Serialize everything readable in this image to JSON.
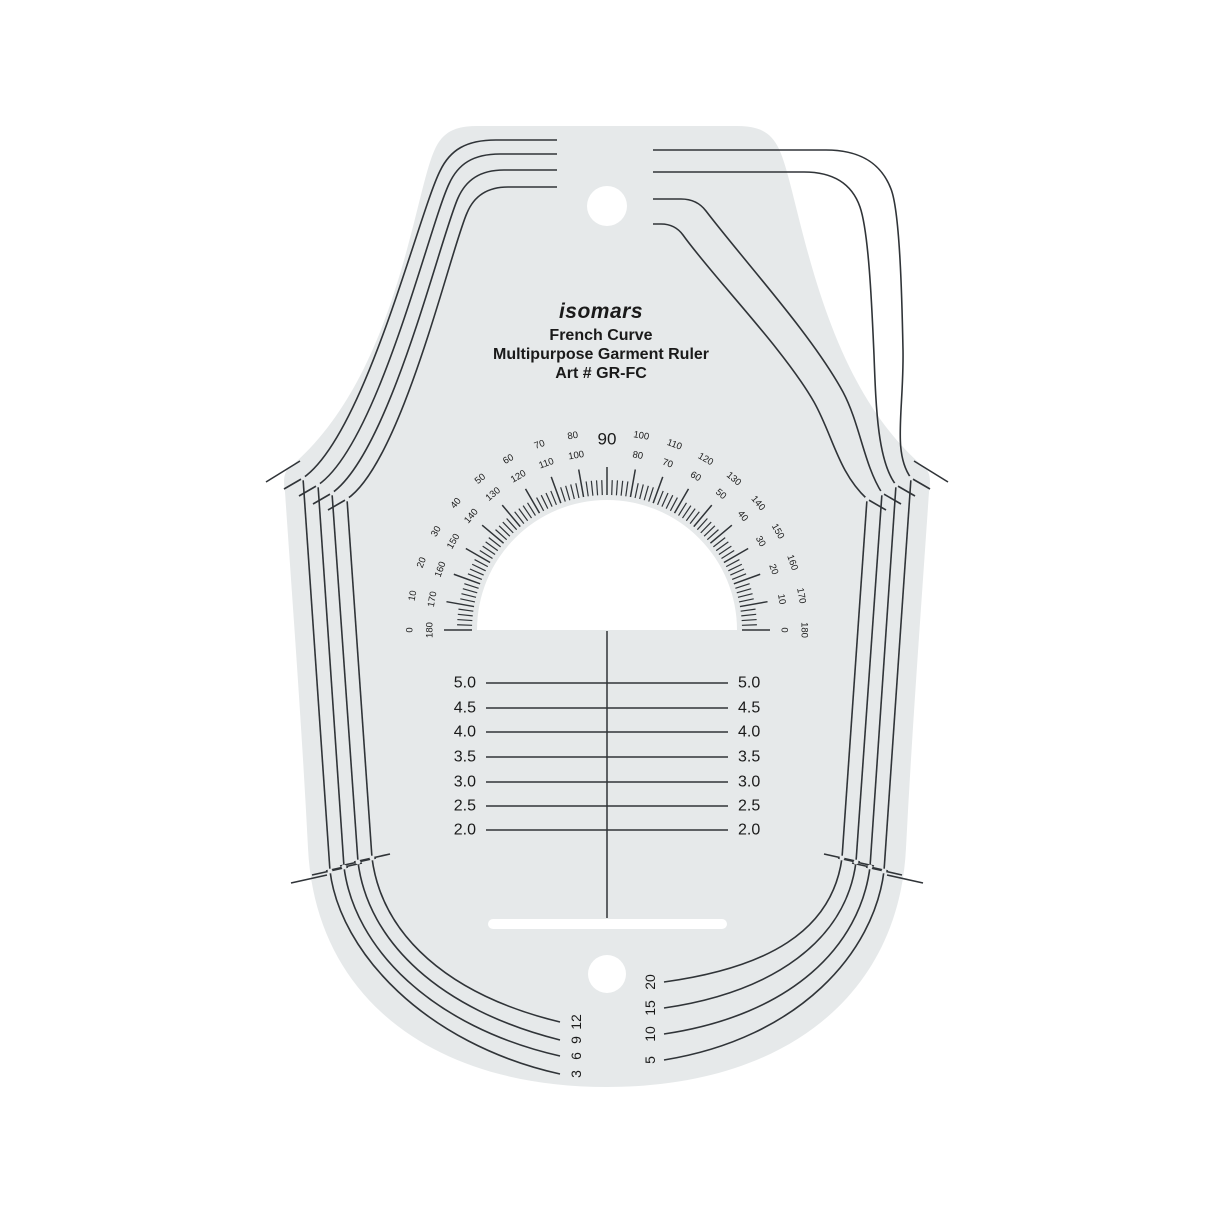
{
  "title_block": {
    "brand": "isomars",
    "product": "French Curve",
    "description": "Multipurpose Garment Ruler",
    "art_code": "Art # GR-FC"
  },
  "protractor": {
    "apex_label": "90",
    "degree_pairs": [
      {
        "angle": 0,
        "outer": "0",
        "inner": "180"
      },
      {
        "angle": 10,
        "outer": "10",
        "inner": "170"
      },
      {
        "angle": 20,
        "outer": "20",
        "inner": "160"
      },
      {
        "angle": 30,
        "outer": "30",
        "inner": "150"
      },
      {
        "angle": 40,
        "outer": "40",
        "inner": "140"
      },
      {
        "angle": 50,
        "outer": "50",
        "inner": "130"
      },
      {
        "angle": 60,
        "outer": "60",
        "inner": "120"
      },
      {
        "angle": 70,
        "outer": "70",
        "inner": "110"
      },
      {
        "angle": 80,
        "outer": "80",
        "inner": "100"
      },
      {
        "angle": 100,
        "outer": "100",
        "inner": "80"
      },
      {
        "angle": 110,
        "outer": "110",
        "inner": "70"
      },
      {
        "angle": 120,
        "outer": "120",
        "inner": "60"
      },
      {
        "angle": 130,
        "outer": "130",
        "inner": "50"
      },
      {
        "angle": 140,
        "outer": "140",
        "inner": "40"
      },
      {
        "angle": 150,
        "outer": "150",
        "inner": "30"
      },
      {
        "angle": 160,
        "outer": "160",
        "inner": "20"
      },
      {
        "angle": 170,
        "outer": "170",
        "inner": "10"
      },
      {
        "angle": 180,
        "outer": "180",
        "inner": "0"
      }
    ]
  },
  "vertical_scale": {
    "values": [
      "5.0",
      "4.5",
      "4.0",
      "3.5",
      "3.0",
      "2.5",
      "2.0"
    ]
  },
  "corner_scales": {
    "bottom_left": [
      "3",
      "6",
      "9",
      "12"
    ],
    "bottom_right": [
      "5",
      "10",
      "15",
      "20"
    ]
  },
  "colors": {
    "body": "#e6e9ea",
    "line": "#303438",
    "text": "#1a1a1a",
    "background": "#ffffff"
  }
}
